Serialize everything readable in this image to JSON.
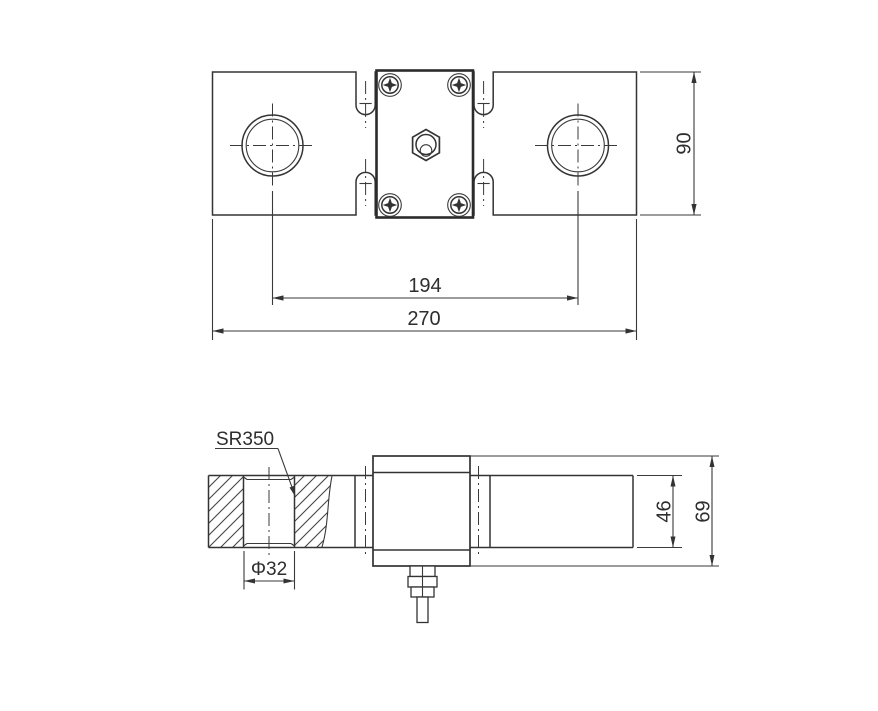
{
  "page": {
    "background": "#ffffff",
    "line_color": "#333333",
    "description": "Technical drawing, load cell with two mounting holes, top view and side section view"
  },
  "top_view": {
    "dim_overall_width": "270",
    "dim_hole_spacing": "194",
    "dim_body_height": "90"
  },
  "side_view": {
    "label_spherical_radius": "SR350",
    "dim_hole_diameter": "Φ32",
    "dim_beam_height": "46",
    "dim_overall_height": "69"
  }
}
